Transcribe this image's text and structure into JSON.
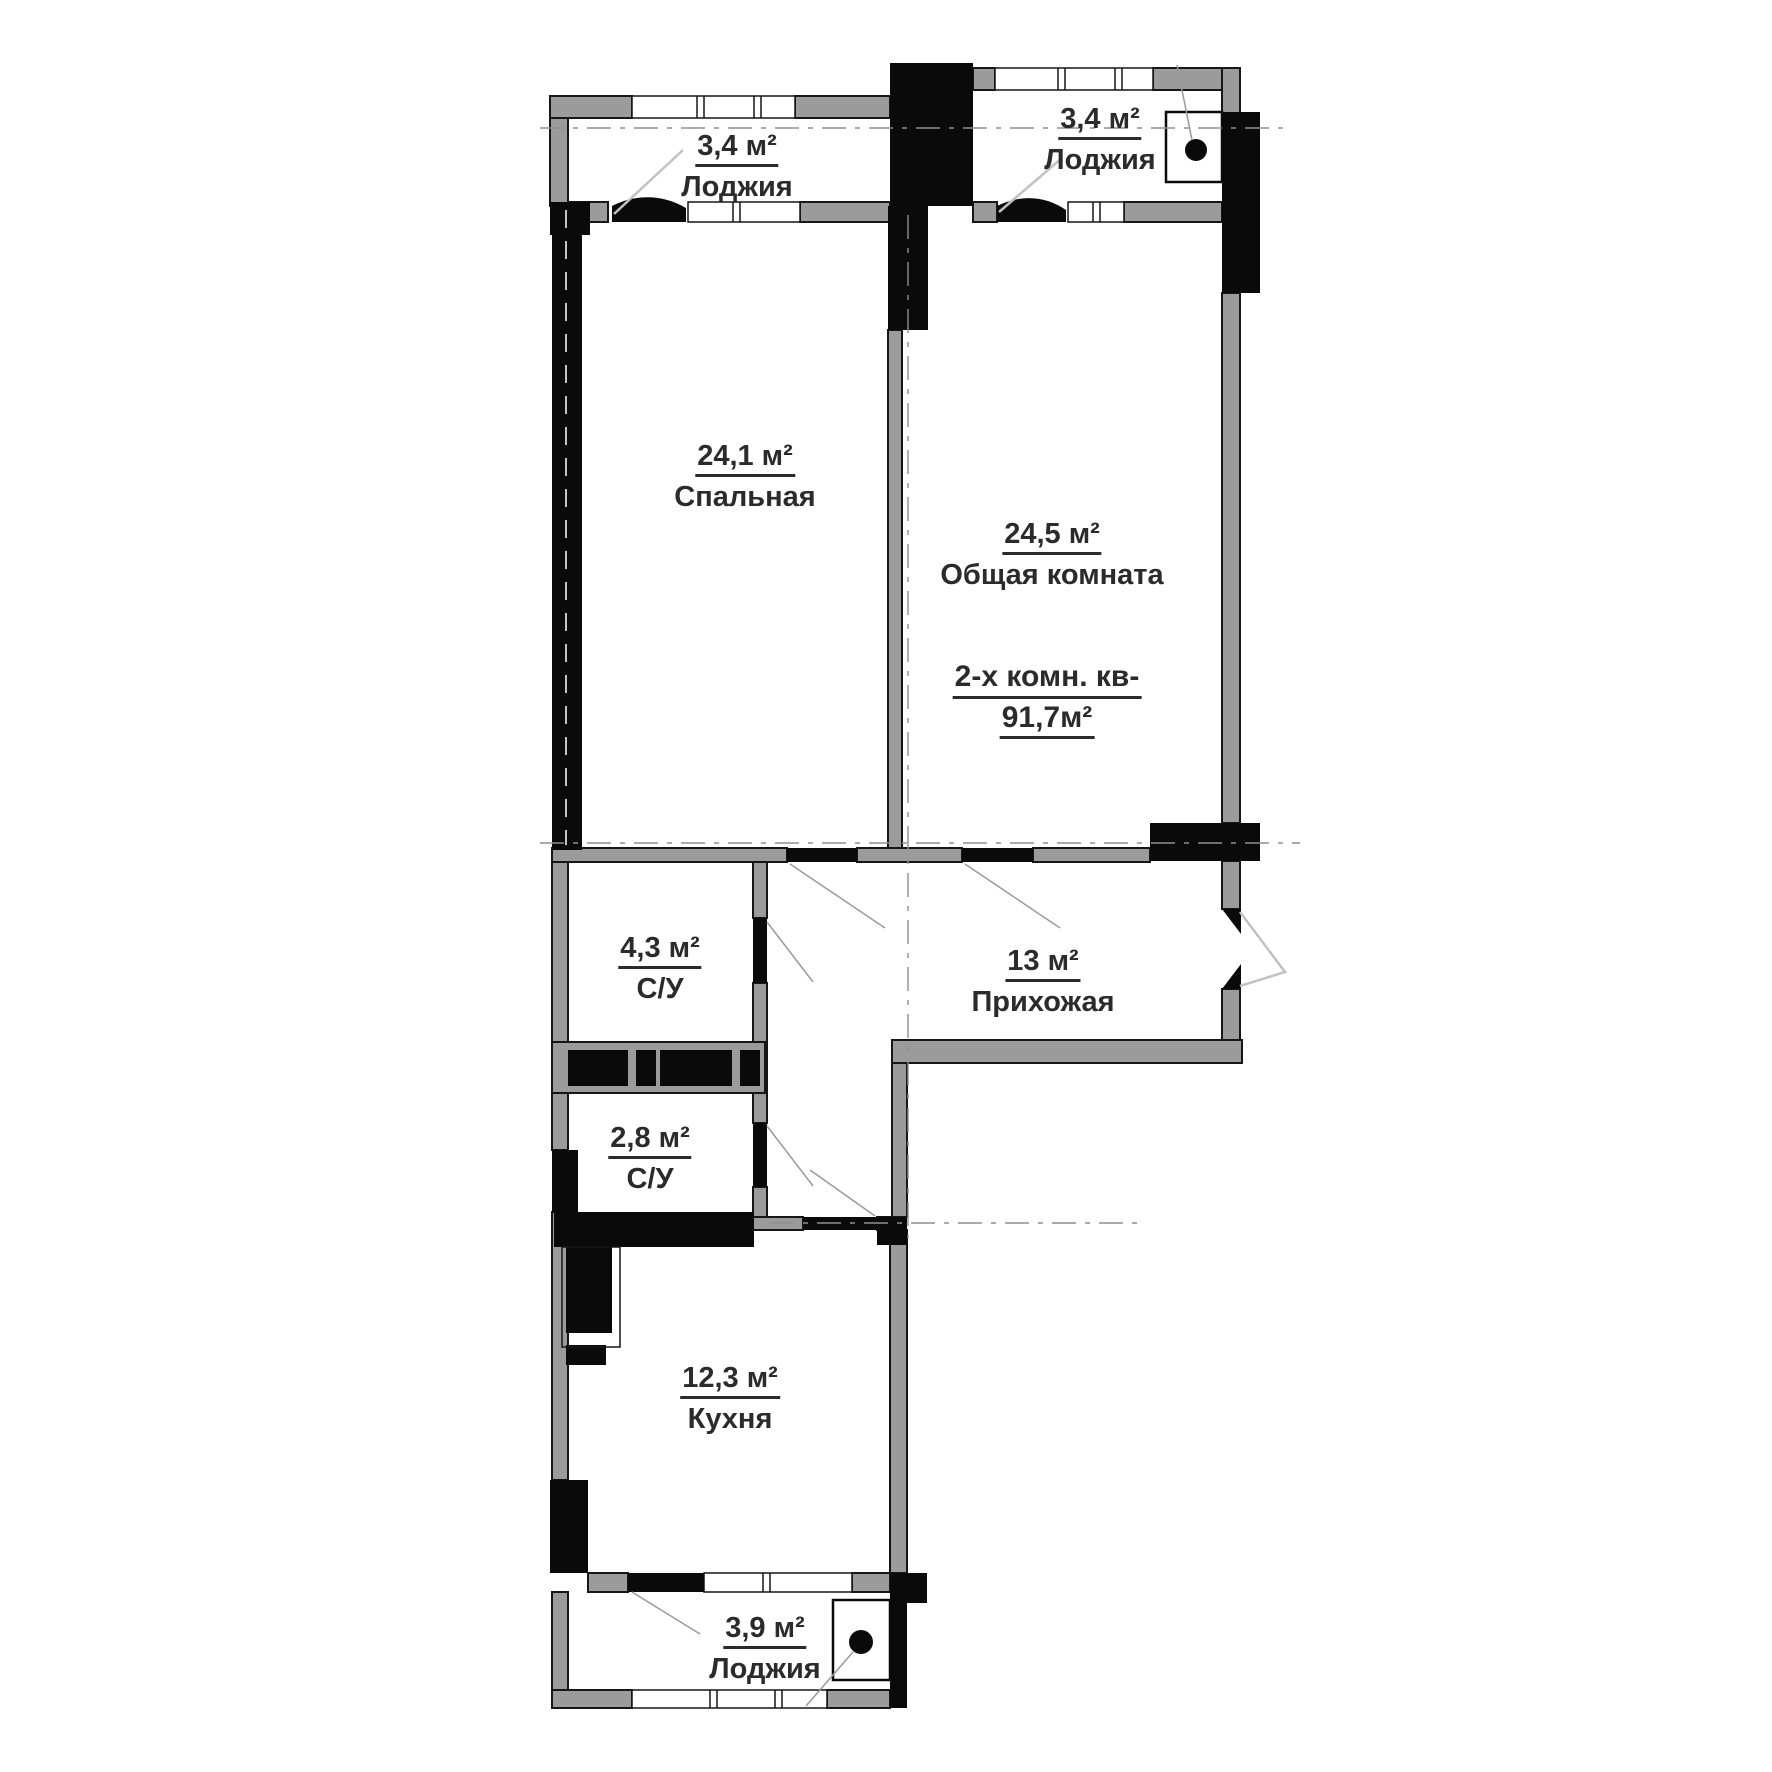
{
  "plan": {
    "apartment_title": {
      "line1": "2-х комн. кв-",
      "line2": "91,7м²"
    },
    "rooms": [
      {
        "id": "loggia-top-left",
        "area": "3,4 м²",
        "name": "Лоджия"
      },
      {
        "id": "loggia-top-right",
        "area": "3,4 м²",
        "name": "Лоджия"
      },
      {
        "id": "bedroom",
        "area": "24,1 м²",
        "name": "Спальная"
      },
      {
        "id": "living-room",
        "area": "24,5 м²",
        "name": "Общая комната"
      },
      {
        "id": "bathroom-large",
        "area": "4,3 м²",
        "name": "С/У"
      },
      {
        "id": "hallway",
        "area": "13 м²",
        "name": "Прихожая"
      },
      {
        "id": "bathroom-small",
        "area": "2,8 м²",
        "name": "С/У"
      },
      {
        "id": "kitchen",
        "area": "12,3 м²",
        "name": "Кухня"
      },
      {
        "id": "loggia-bottom",
        "area": "3,9 м²",
        "name": "Лоджия"
      }
    ],
    "colors": {
      "wall_gray": "#9b9b9b",
      "structure_black": "#0a0a0a",
      "background": "#ffffff",
      "text": "#2b2b2b"
    }
  }
}
